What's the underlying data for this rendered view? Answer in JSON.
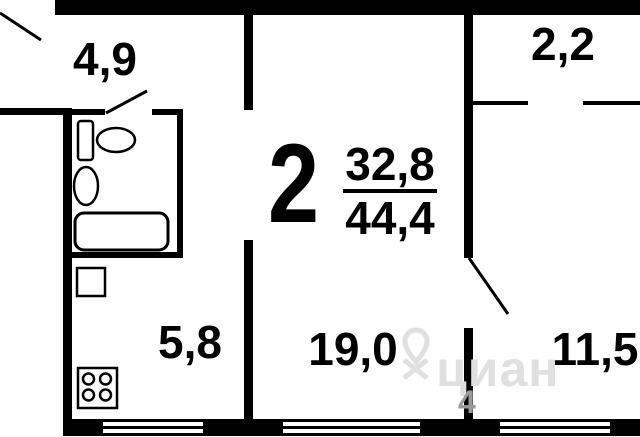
{
  "plan": {
    "title": "2-room apartment floor plan",
    "rooms": [
      {
        "id": "hallway",
        "area": "4,9"
      },
      {
        "id": "closet",
        "area": "2,2"
      },
      {
        "id": "kitchen",
        "area": "5,8"
      },
      {
        "id": "living-room",
        "area": "19,0"
      },
      {
        "id": "bedroom",
        "area": "11,5"
      }
    ],
    "summary": {
      "rooms_count": "2",
      "living_area": "32,8",
      "total_area": "44,4"
    }
  },
  "watermark": {
    "brand": "циан",
    "digit": "4"
  },
  "colors": {
    "wall": "#000000",
    "background": "#ffffff",
    "watermark": "#e0e0e0"
  }
}
